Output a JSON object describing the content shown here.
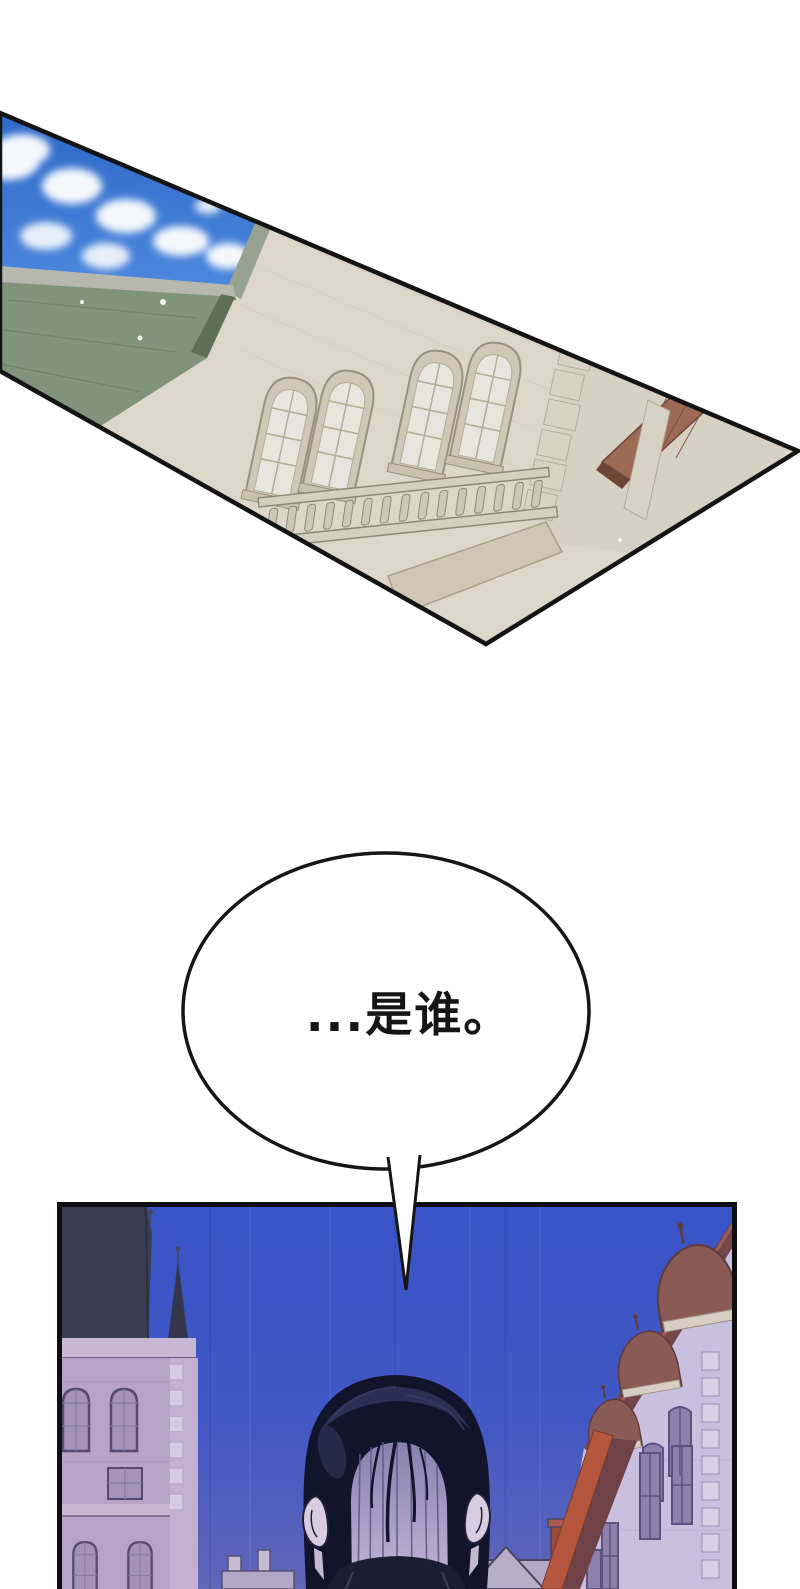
{
  "page": {
    "width": 800,
    "height": 1589,
    "background": "#ffffff"
  },
  "speech_bubble": {
    "text": "...是谁。",
    "fill": "#ffffff",
    "outline": "#161616",
    "text_color": "#151515"
  },
  "panels": {
    "top": {
      "border": "#141414",
      "wall": "#ddd7c9",
      "wall_shade": "#d6d1c3",
      "sky_top": "#2d68c8",
      "sky_bottom": "#4e88de",
      "cloud": "#f4f8fc",
      "fascia": "#b6b8ae",
      "roof": "#7f947a",
      "roof_dark": "#5f7058",
      "window_frame": "#cfc8b6",
      "window_glass": "#e7e5dd",
      "stone_trim": "#d9d3c4",
      "balustrade": "#d6d0bf",
      "eave_brown": "#9c6a55",
      "eave_dark": "#6e4638"
    },
    "bottom": {
      "border": "#0e0e12",
      "sky_top": "#3a53c6",
      "sky_mid": "#4157c5",
      "sky_bottom": "#6066b8",
      "left_roof": "#3a3c52",
      "left_wall": "#b7a3c8",
      "left_tower_wall": "#c3b0d1",
      "left_trim": "#c7b6d4",
      "left_window": "#a393ba",
      "left_window_frame": "#564870",
      "right_wall": "#c9bfde",
      "right_window": "#8d80ab",
      "right_window_frame": "#5d517f",
      "right_eave": "#74454a",
      "right_eave_bright": "#b5563f",
      "right_slope": "#6f4247",
      "dormer": "#8a5a54",
      "dormer_dark": "#5f3c3c",
      "quoin": "#d9d0e6",
      "distant_wall": "#b3a9c6",
      "distant_outline": "#4a4663",
      "chimney_red": "#9c4a40",
      "hair": "#12142c",
      "hair_sheen": "#2e3258",
      "nape_top": "#877fae",
      "nape_bottom": "#c4b8d8",
      "nape_streak": "#5f5a85",
      "skin": "#d8cce0",
      "ear_outline": "#241f38",
      "collar": "#1b1e33"
    }
  }
}
